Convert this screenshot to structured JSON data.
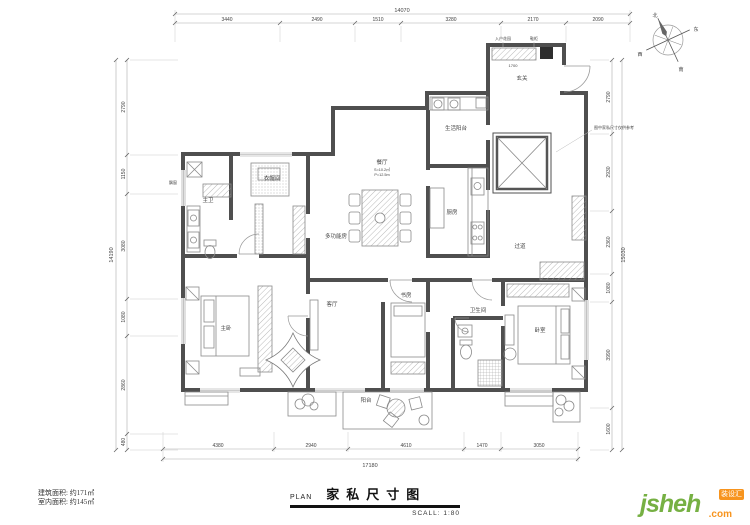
{
  "title_block": {
    "plan_label": "PLAN",
    "title": "家私尺寸图",
    "scale": "SCALL: 1:80"
  },
  "areas": {
    "building": "建筑面积: 约171㎡",
    "interior": "室内面积: 约145㎡"
  },
  "logo": {
    "text": "jsheh",
    "suffix": ".com",
    "badge": "装设汇"
  },
  "compass": {
    "north": "北",
    "south": "南",
    "east": "东",
    "west": "西"
  },
  "dimensions": {
    "top": {
      "total": "14070",
      "segments": [
        "3440",
        "2490",
        "1510",
        "3280",
        "2170",
        "2090"
      ]
    },
    "bottom": {
      "total": "17180",
      "segments": [
        "4380",
        "2940",
        "4610",
        "1470",
        "3050"
      ]
    },
    "left": {
      "total": "14190",
      "segments": [
        "2790",
        "1150",
        "3080",
        "1080",
        "2860",
        "480"
      ]
    },
    "right": {
      "total": "15030",
      "segments": [
        "2790",
        "2930",
        "2360",
        "1080",
        "3990",
        "1600"
      ]
    }
  },
  "rooms": [
    {
      "label": "主卫"
    },
    {
      "label": "衣帽间"
    },
    {
      "label": "多功能房"
    },
    {
      "label": "餐厅",
      "sub1": "S=10.2㎡",
      "sub2": "P=12.5m"
    },
    {
      "label": "厨房"
    },
    {
      "label": "生活阳台"
    },
    {
      "label": "玄关"
    },
    {
      "label": "过道"
    },
    {
      "label": "主卧"
    },
    {
      "label": "客厅"
    },
    {
      "label": "书房"
    },
    {
      "label": "卫生间"
    },
    {
      "label": "卧室"
    },
    {
      "label": "阳台"
    }
  ],
  "annotations": {
    "entry_garden": "入户花园",
    "shoe_cabinet": "鞋柜",
    "bay_window": "飘窗",
    "note": "图中家私尺寸仅供参考",
    "cabinet_dim": "1700"
  }
}
